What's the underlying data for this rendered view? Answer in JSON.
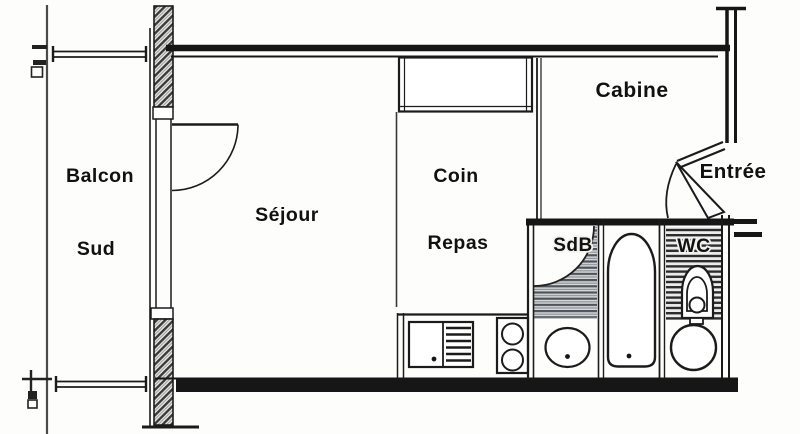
{
  "figure": {
    "type": "floor-plan",
    "language": "fr"
  },
  "rooms": {
    "balcony": {
      "label_line1": "Balcon",
      "label_line2": "Sud"
    },
    "living_room": {
      "label": "Séjour"
    },
    "dining_corner": {
      "label_line1": "Coin",
      "label_line2": "Repas"
    },
    "cabin": {
      "label": "Cabine"
    },
    "entrance": {
      "label": "Entrée"
    },
    "bathroom": {
      "label": "SdB"
    },
    "toilet_room": {
      "label": "WC"
    }
  },
  "fixtures": [
    {
      "name": "balcony-door-swing"
    },
    {
      "name": "entrance-door-swing"
    },
    {
      "name": "bathroom-door-swing"
    },
    {
      "name": "closet"
    },
    {
      "name": "kitchen-sink"
    },
    {
      "name": "cooktop"
    },
    {
      "name": "bathtub"
    },
    {
      "name": "washbasin"
    },
    {
      "name": "toilet"
    },
    {
      "name": "wc-washbasin"
    },
    {
      "name": "balcony-railing"
    }
  ],
  "colors": {
    "background": "#fdfdfb",
    "line": "#1b1b1b",
    "wall_hatch_dark": "#3a3a3a",
    "wall_hatch_bg": "#e9e9e7",
    "bathroom_stripe": "#4e545a",
    "wc_stripe": "#2c2c2c"
  }
}
